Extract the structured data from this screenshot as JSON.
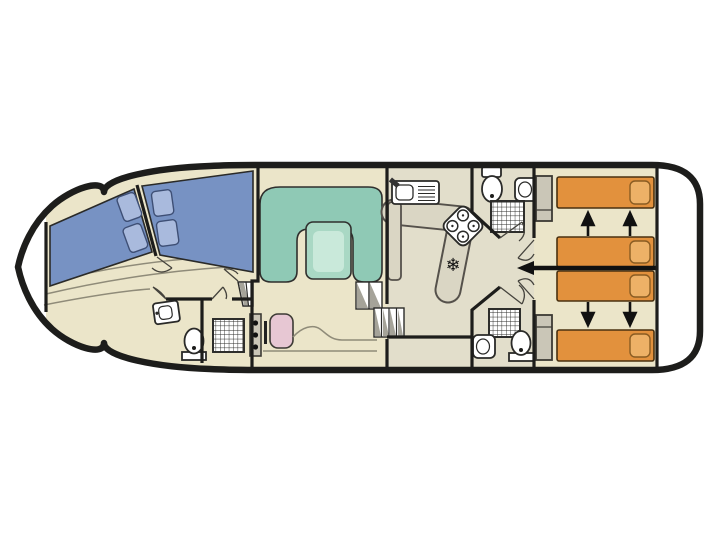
{
  "plan": {
    "type": "boat-floor-plan",
    "fridge_symbol": "❄"
  },
  "colors": {
    "background": "#ffffff",
    "hull": "#1d1d1b",
    "deck": "#ffffff",
    "floor": "#ebe5c9",
    "floor_galley": "#e2decb",
    "bed_blue": "#7792c3",
    "pillow_blue": "#a9badd",
    "sofa_teal": "#8fc9b5",
    "table_green": "#a9d8c4",
    "table_top": "#c9e9da",
    "bed_orange": "#e2913d",
    "pillow_orange": "#edb167",
    "seat_pink": "#e7c7d3",
    "cabinet_gray": "#cac6b7",
    "counter_gray": "#dad6c4",
    "counter_edge": "#55514b",
    "fixture_white": "#ffffff",
    "shade_gray": "#a5a399",
    "arrow_black": "#111111"
  }
}
